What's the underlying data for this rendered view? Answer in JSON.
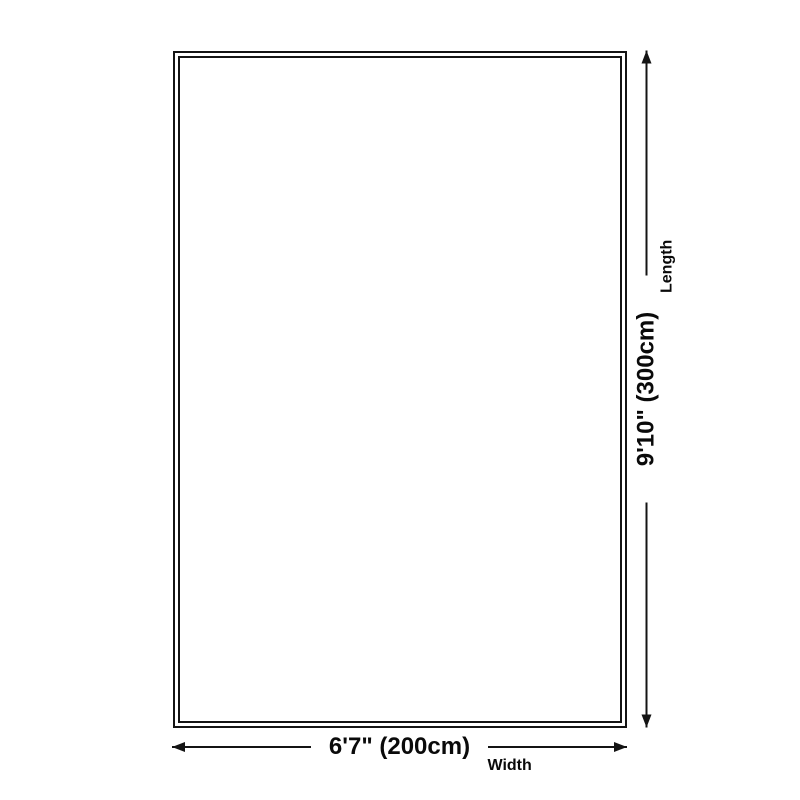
{
  "dimensions": {
    "width": {
      "value": "6'7\" (200cm)",
      "label": "Width"
    },
    "length": {
      "value": "9'10\" (300cm)",
      "label": "Length"
    }
  },
  "colors": {
    "line": "#141414",
    "text": "#0a0a0a",
    "background": "#ffffff"
  }
}
